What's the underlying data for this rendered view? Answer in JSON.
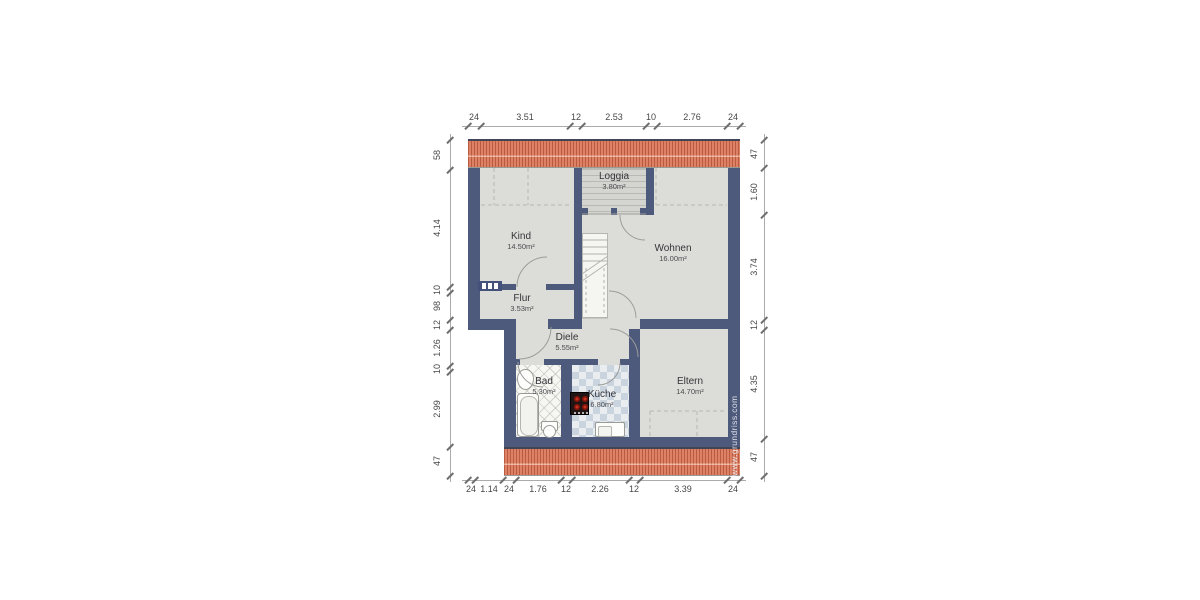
{
  "watermark": "www.grundriss.com",
  "rooms": {
    "loggia": {
      "name": "Loggia",
      "area": "3.80m²"
    },
    "kind": {
      "name": "Kind",
      "area": "14.50m²"
    },
    "wohnen": {
      "name": "Wohnen",
      "area": "16.00m²"
    },
    "flur": {
      "name": "Flur",
      "area": "3.53m²"
    },
    "diele": {
      "name": "Diele",
      "area": "5.55m²"
    },
    "bad": {
      "name": "Bad",
      "area": "5.30m²"
    },
    "kueche": {
      "name": "Küche",
      "area": "6.80m²"
    },
    "eltern": {
      "name": "Eltern",
      "area": "14.70m²"
    }
  },
  "dimensions": {
    "top": [
      "24",
      "3.51",
      "12",
      "2.53",
      "10",
      "2.76",
      "24"
    ],
    "bottom": [
      "24",
      "1.14",
      "24",
      "1.76",
      "12",
      "2.26",
      "12",
      "3.39",
      "24"
    ],
    "left": [
      "58",
      "4.14",
      "10",
      "98",
      "12",
      "1.26",
      "10",
      "2.99",
      "47"
    ],
    "right": [
      "47",
      "1.60",
      "3.74",
      "12",
      "4.35",
      "47"
    ]
  },
  "colors": {
    "roof": "#dd8266",
    "wall": "#4d5a7c",
    "floor": "#dcdcd8"
  }
}
